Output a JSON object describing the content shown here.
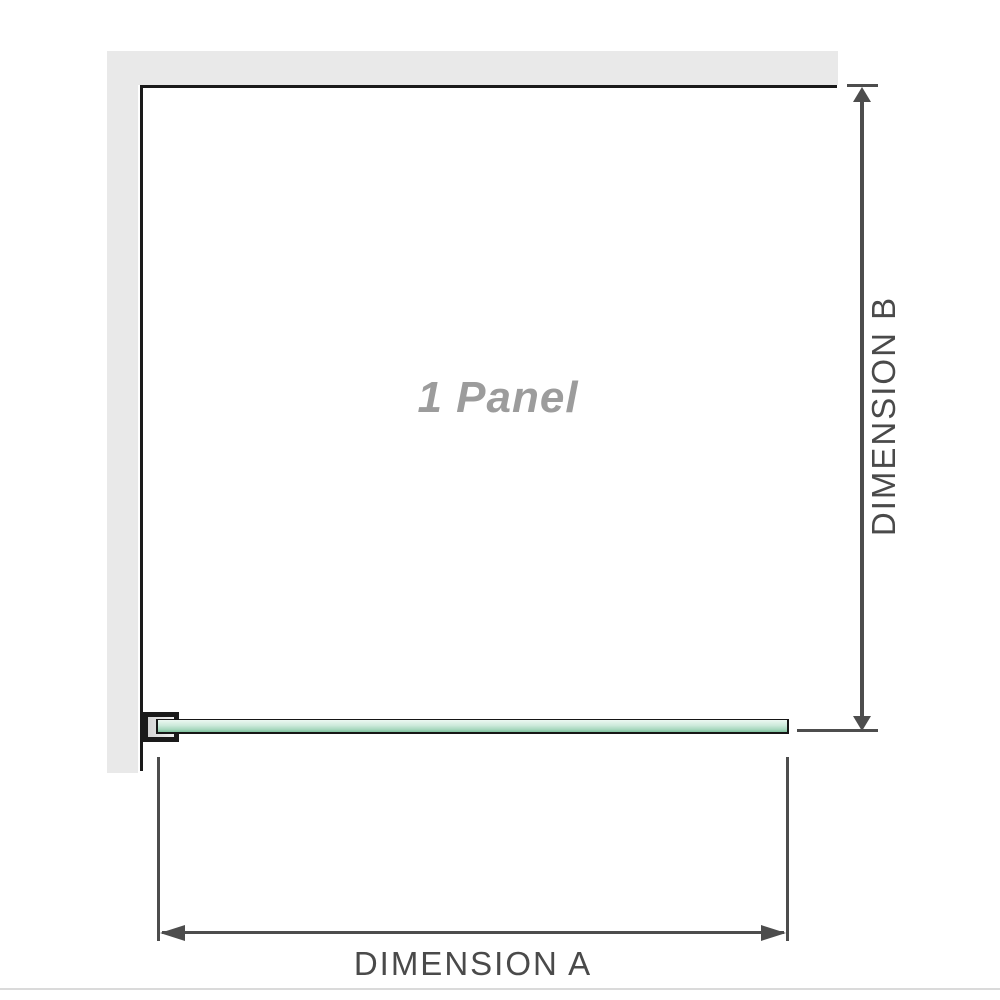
{
  "diagram": {
    "panel_label": "1 Panel",
    "dimension_a_label": "DIMENSION A",
    "dimension_b_label": "DIMENSION B"
  },
  "colors": {
    "wall": "#e9e9e9",
    "outline": "#1a1a1a",
    "dim_line": "#4d4d4d",
    "dim_text": "#4a4a4a",
    "panel_text": "#9c9c9c",
    "glass_top": "#edf8f2",
    "glass_mid": "#a8d8bf",
    "glass_bottom": "#7fc29e",
    "divider": "#dadada"
  }
}
